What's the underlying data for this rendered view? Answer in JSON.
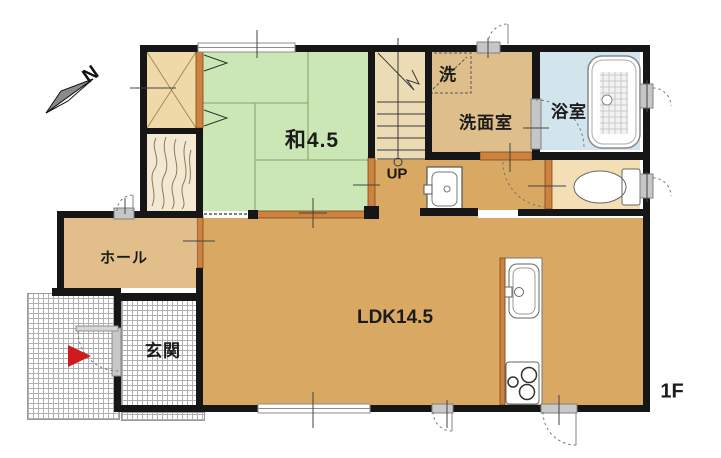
{
  "floor_plan": {
    "floor_label": "1F",
    "compass_label": "N",
    "rooms": {
      "washitsu": {
        "label": "和4.5"
      },
      "ldk": {
        "label": "LDK14.5"
      },
      "senmenshitsu": {
        "label": "洗面室"
      },
      "laundry": {
        "label": "洗"
      },
      "bathroom": {
        "label": "浴室"
      },
      "hall": {
        "label": "ホール"
      },
      "genkan": {
        "label": "玄関"
      },
      "stairs": {
        "label": "UP"
      }
    },
    "colors": {
      "wall": "#161616",
      "ldk_floor": "#d9a862",
      "tatami": "#cbe7b5",
      "bath_floor": "#d2e4ec",
      "hall_floor": "#e2bf8a",
      "toilet_floor": "#f2dfb5",
      "closet_floor": "#f0d9a9",
      "wood_floor": "#f3e9d3",
      "stairs_floor": "#ecdcb6",
      "senmen_floor": "#debe8a",
      "door_accent": "#cd8240",
      "entry_marker": "#cf1b1b"
    }
  }
}
